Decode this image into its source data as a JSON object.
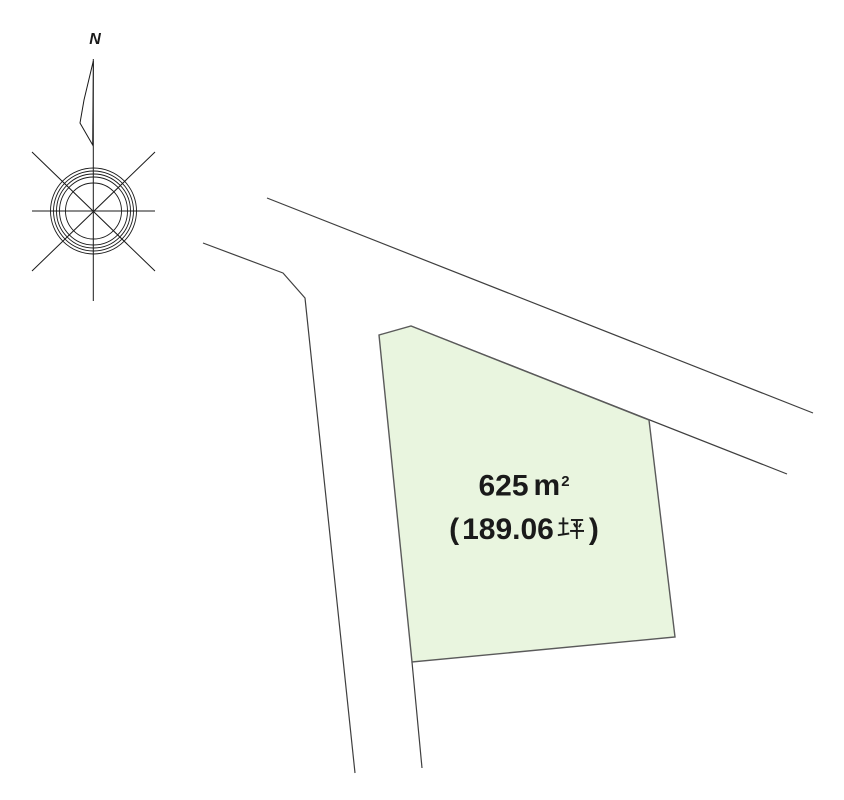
{
  "page": {
    "background": "#ffffff",
    "description": "Land parcel site plan drawing"
  },
  "compass": {
    "north_label": "N"
  },
  "plot": {
    "area_sqm_text": "625㎡",
    "area_tsubo_text": "（189.06坪）",
    "display": {
      "sqm_value": "625",
      "sqm_unit_base": "m",
      "sqm_unit_exponent": "2",
      "tsubo_open": "(",
      "tsubo_value": "189.06",
      "tsubo_unit": "坪",
      "tsubo_close": ")"
    },
    "fill_color": "#e9f5df",
    "outline_color": "#5a5a5a"
  },
  "drawing": {
    "road_line_color": "#3f3f3f",
    "compass_line_color": "#1a1a1a",
    "text_color": "#1a1a1a"
  }
}
